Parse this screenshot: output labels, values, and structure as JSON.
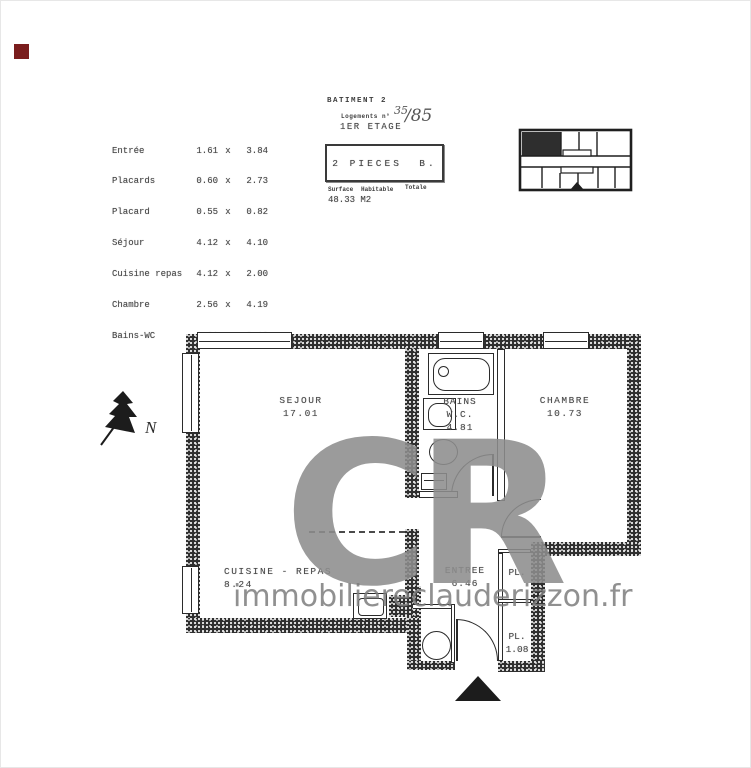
{
  "colors": {
    "marker_red": "#7a1d1d",
    "watermark_gray": "#8d8d8d",
    "ink": "#2b2b2b"
  },
  "room_table": {
    "sep": "x",
    "rows": [
      {
        "name": "Entrée",
        "w": "1.61",
        "h": "3.84"
      },
      {
        "name": "Placards",
        "w": "0.60",
        "h": "2.73"
      },
      {
        "name": "Placard",
        "w": "0.55",
        "h": "0.82"
      },
      {
        "name": "Séjour",
        "w": "4.12",
        "h": "4.10"
      },
      {
        "name": "Cuisine repas",
        "w": "4.12",
        "h": "2.00"
      },
      {
        "name": "Chambre",
        "w": "2.56",
        "h": "4.19"
      },
      {
        "name": "Bains-WC",
        "w": "1.61",
        "h": "3.13"
      }
    ]
  },
  "header": {
    "batiment": "BATIMENT  2",
    "logements_label": "Logements  n°",
    "lot_number": "35",
    "lot_total": "/85",
    "etage": "1ER ETAGE",
    "type_box": "2 PIECES  B.",
    "surface_word1": "Surface",
    "surface_word2": "Habitable",
    "surface_word3": "Totale",
    "surface_value": "48.33 M2"
  },
  "plan": {
    "north_label": "N",
    "sejour": {
      "name": "SEJOUR",
      "area": "17.01"
    },
    "bains": {
      "line1": "BAINS",
      "line2": "W.C.",
      "area": "4.81"
    },
    "chambre": {
      "name": "CHAMBRE",
      "area": "10.73"
    },
    "cuisine": {
      "name": "CUISINE - REPAS",
      "area": "8.24"
    },
    "entree": {
      "name": "ENTREE",
      "area": "6.46"
    },
    "placard_top": {
      "name": "PL."
    },
    "placard_bottom": {
      "name": "PL.",
      "area": "1.08"
    }
  },
  "watermark": {
    "logo": "CR",
    "url": "immobiliereclauderizzon.fr"
  }
}
